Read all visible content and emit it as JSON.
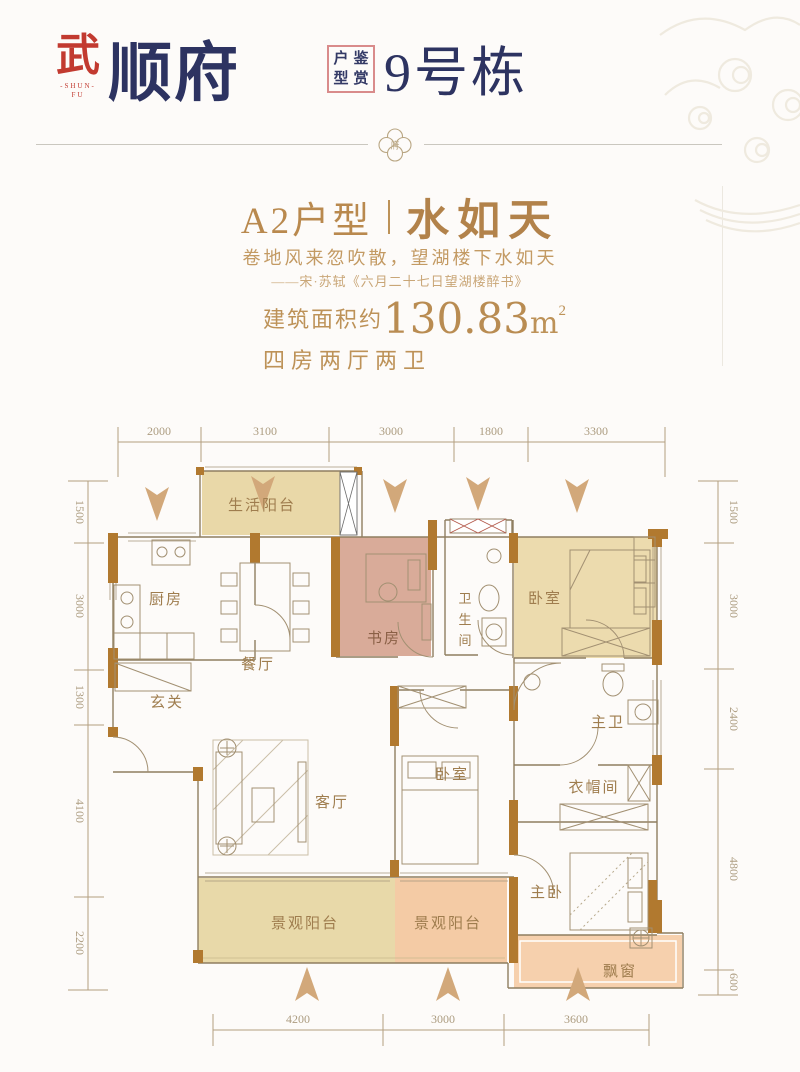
{
  "header": {
    "logo": {
      "seal_char": "武",
      "seal_sub1": "-SHUN-",
      "seal_sub2": "FU",
      "brand": "顺府"
    },
    "stamp_chars": [
      "户",
      "鉴",
      "型",
      "赏"
    ],
    "stamp_meaning": "户型鉴赏",
    "building": "9号栋"
  },
  "divider_ornament": "府",
  "intro": {
    "plan_code": "A2户型",
    "plan_name": "水如天",
    "poem": "卷地风来忽吹散，望湖楼下水如天",
    "poem_source": "——宋·苏轼《六月二十七日望湖楼醉书》",
    "area_label": "建筑面积约",
    "area_value": "130.83",
    "area_unit": "m",
    "area_sup": "2",
    "layout": "四房两厅两卫"
  },
  "floorplan": {
    "rooms": {
      "service_balcony": "生活阳台",
      "kitchen": "厨房",
      "dining": "餐厅",
      "study": "书房",
      "bath1_chars": [
        "卫",
        "生",
        "间"
      ],
      "bedroom1": "卧室",
      "entry": "玄关",
      "living": "客厅",
      "bedroom2": "卧室",
      "master_bath": "主卫",
      "cloakroom": "衣帽间",
      "master_bedroom": "主卧",
      "view_balcony": "景观阳台",
      "bay_window": "飘窗"
    },
    "dims": {
      "top": [
        "2000",
        "3100",
        "3000",
        "1800",
        "3300"
      ],
      "bottom": [
        "4200",
        "3000",
        "3600"
      ],
      "left": [
        "1500",
        "3000",
        "1300",
        "4100",
        "2200"
      ],
      "right": [
        "1500",
        "3000",
        "2400",
        "4800",
        "600"
      ]
    },
    "colors": {
      "wall_brown": "#b1792f",
      "balcony_tan": "#e9d8a8",
      "study_pink": "#d9ab99",
      "bedroom_tan": "#ecdbae",
      "balcony_peach": "#f4cba5",
      "bay_peach": "#f6d0ad",
      "arrow_tan": "#d2a87a",
      "accent_gold": "#bd9258",
      "brand_navy": "#2d3361",
      "seal_red": "#c23a30"
    }
  }
}
